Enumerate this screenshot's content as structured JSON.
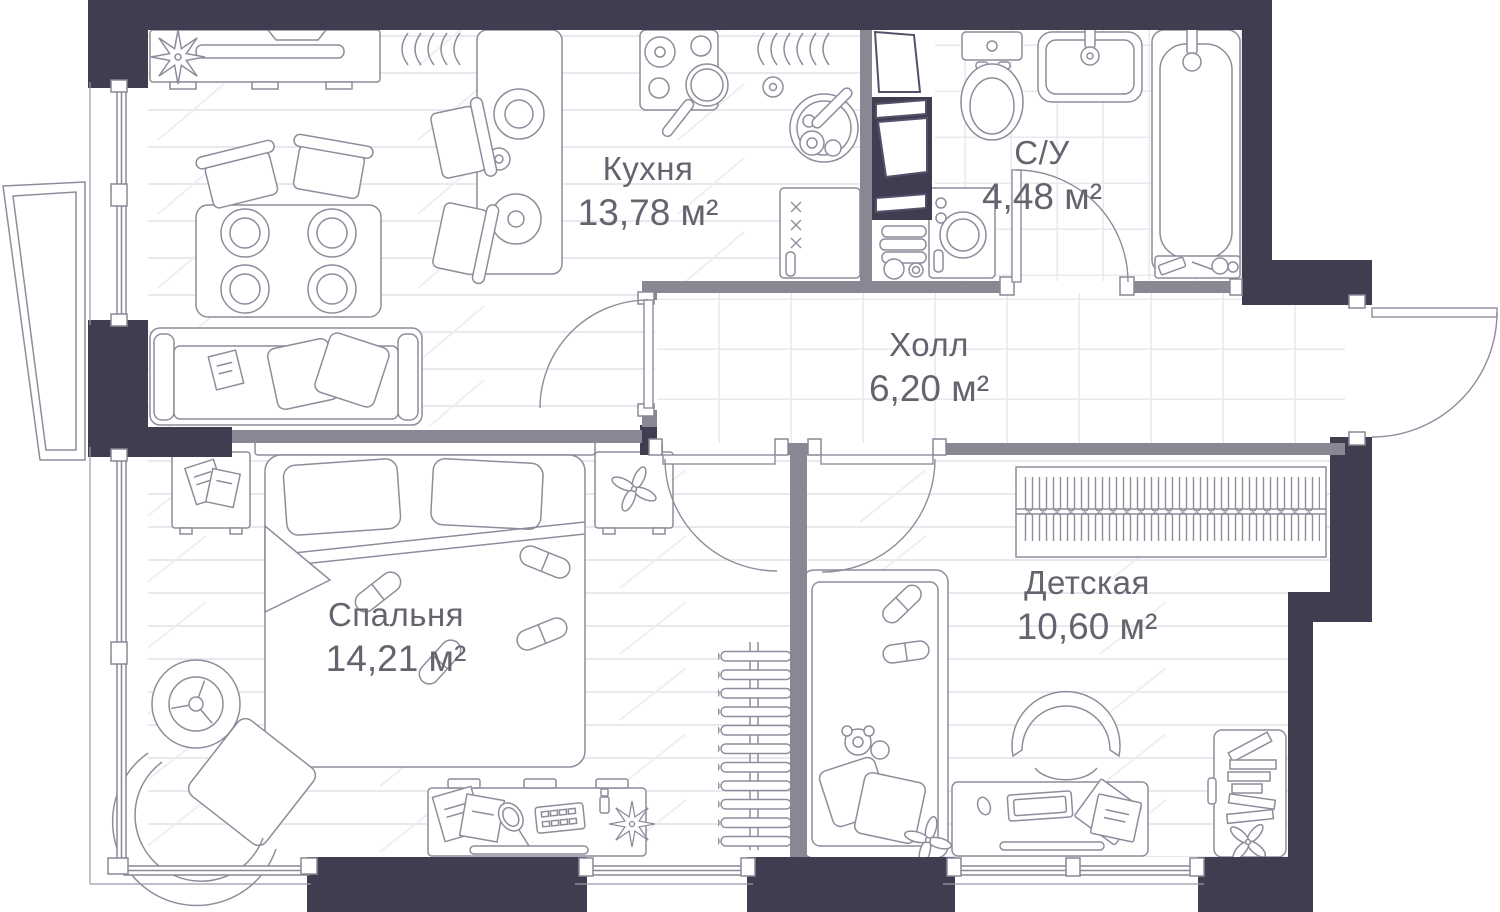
{
  "plan": {
    "type": "apartment-floor-plan",
    "rooms": [
      {
        "key": "kitchen",
        "name": "Кухня",
        "area": "13,78 м²"
      },
      {
        "key": "bathroom",
        "name": "С/У",
        "area": "4,48 м²"
      },
      {
        "key": "hall",
        "name": "Холл",
        "area": "6,20 м²"
      },
      {
        "key": "bedroom",
        "name": "Спальня",
        "area": "14,21 м²"
      },
      {
        "key": "children",
        "name": "Детская",
        "area": "10,60 м²"
      }
    ],
    "colors": {
      "exterior_wall": "#413d50",
      "interior_wall": "#8a8795",
      "furniture_line": "#8f8c9b",
      "floor_hatch": "#e9e8ee",
      "floor": "#ffffff",
      "label_text": "#66636f"
    }
  }
}
